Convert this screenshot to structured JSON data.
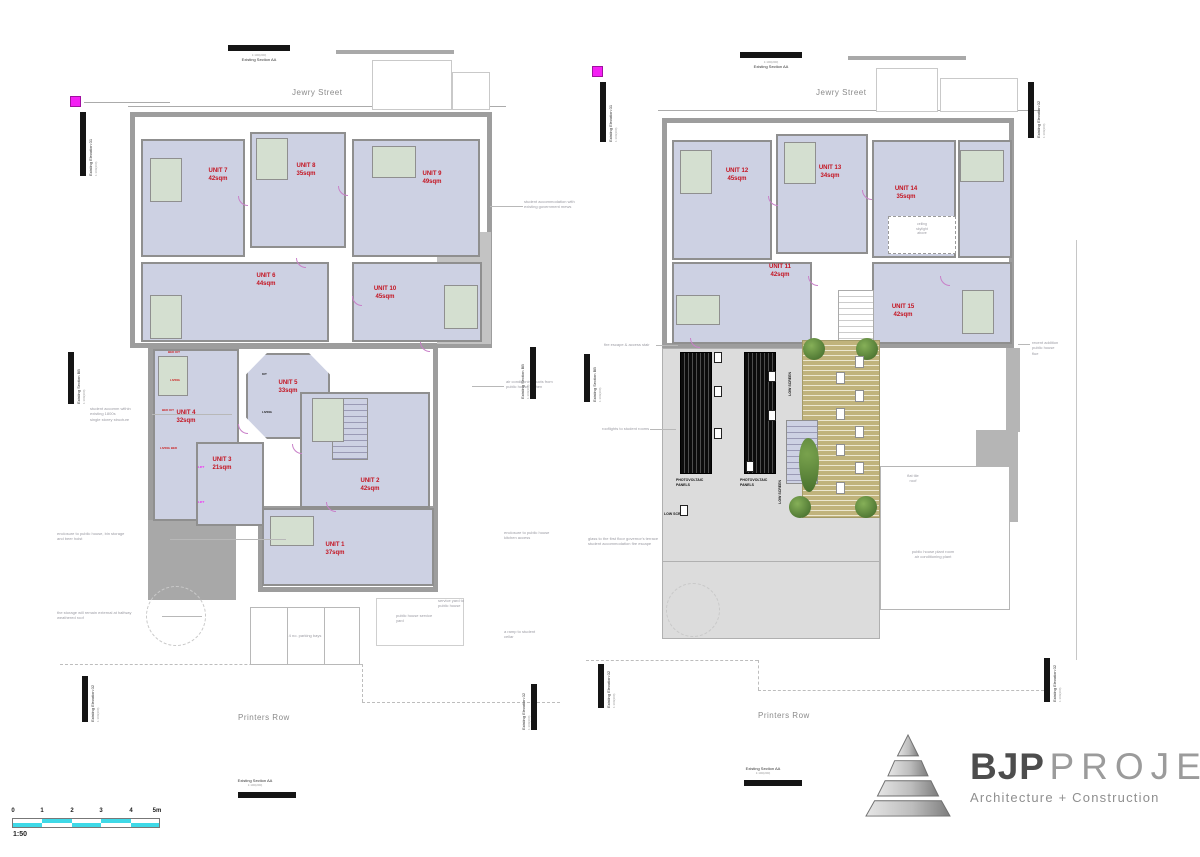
{
  "sheet": {
    "scale_ratio": "1:50"
  },
  "streets": {
    "top": "Jewry Street",
    "bottom": "Printers Row"
  },
  "markers": {
    "section_aa": "Existing Section AA",
    "section_bb": "Existing Section BB",
    "elevation_01": "Existing Elevation 01",
    "elevation_02": "Existing Elevation 02",
    "ratio": "1:100(200)"
  },
  "plan1": {
    "units": [
      {
        "name": "UNIT 1",
        "area": "37sqm"
      },
      {
        "name": "UNIT 2",
        "area": "42sqm"
      },
      {
        "name": "UNIT 3",
        "area": "21sqm"
      },
      {
        "name": "UNIT 4",
        "area": "32sqm"
      },
      {
        "name": "UNIT 5",
        "area": "33sqm"
      },
      {
        "name": "UNIT 6",
        "area": "44sqm"
      },
      {
        "name": "UNIT 7",
        "area": "42sqm"
      },
      {
        "name": "UNIT 8",
        "area": "35sqm"
      },
      {
        "name": "UNIT 9",
        "area": "49sqm"
      },
      {
        "name": "UNIT 10",
        "area": "45sqm"
      }
    ],
    "annotations": [
      {
        "lines": [
          "student accommodation with",
          "existing government mews"
        ]
      },
      {
        "lines": [
          "air conditioning ducts from",
          "public house kitchen"
        ]
      },
      {
        "lines": [
          "student accomm within",
          "existing 1800s",
          "single storey structure"
        ]
      },
      {
        "lines": [
          "enclosure to public house, bin storage",
          "and beer hoist"
        ]
      },
      {
        "lines": [
          "the storage will remain external at halfway",
          "weathered roof"
        ]
      },
      {
        "lines": [
          "public house service",
          "yard"
        ]
      },
      {
        "lines": [
          "4 no. parking bays"
        ]
      },
      {
        "lines": [
          "a ramp to student",
          "cellar"
        ]
      },
      {
        "lines": [
          "service yard to",
          "public house"
        ]
      },
      {
        "lines": [
          "enclosure to public house",
          "kitchen access"
        ]
      }
    ],
    "room_labels": [
      {
        "text": "BED KIT"
      },
      {
        "text": "LIVING"
      },
      {
        "text": "BED KIT"
      },
      {
        "text": "LIVING BED"
      },
      {
        "text": "KIT"
      },
      {
        "text": "LIVING"
      },
      {
        "text": "LIFT"
      },
      {
        "text": "LIFT"
      }
    ]
  },
  "plan2": {
    "units": [
      {
        "name": "UNIT 11",
        "area": "42sqm"
      },
      {
        "name": "UNIT 12",
        "area": "45sqm"
      },
      {
        "name": "UNIT 13",
        "area": "34sqm"
      },
      {
        "name": "UNIT 14",
        "area": "35sqm"
      },
      {
        "name": "UNIT 15",
        "area": "42sqm"
      }
    ],
    "labels": {
      "pv_line1": "PHOTOVOLTAIC",
      "pv_line2": "PANELS",
      "low_screen": "LOW SCREEN"
    },
    "annotations": [
      {
        "lines": [
          "fire escape & access stair"
        ]
      },
      {
        "lines": [
          "rooflights to student rooms"
        ]
      },
      {
        "lines": [
          "glass to the first floor governor's terrace",
          "student accommodation fire escape"
        ]
      },
      {
        "lines": [
          "recent addition",
          "public house",
          "flue"
        ]
      },
      {
        "lines": [
          "flat tile",
          "roof"
        ]
      },
      {
        "lines": [
          "public house plant room",
          "air conditioning plant"
        ]
      },
      {
        "lines": [
          "ceiling",
          "skylight",
          "above"
        ]
      }
    ]
  },
  "scalebar": {
    "ticks": [
      "0",
      "1",
      "2",
      "3",
      "4",
      "5m"
    ],
    "ratio": "1:50"
  },
  "logo": {
    "bjp": "BJP",
    "projects": "PROJECTS",
    "subtitle": "Architecture + Construction"
  },
  "colors": {
    "unit_fill": "#cdd1e3",
    "wall_grey": "#9d9d9d",
    "unit_label_red": "#c41320",
    "marker_magenta": "#f420f4",
    "scalebar_cyan": "#3fd9e7",
    "deck_tan": "#c0b37c",
    "tree_green": "#4c7a31",
    "pv_black": "#0c0c0c"
  }
}
